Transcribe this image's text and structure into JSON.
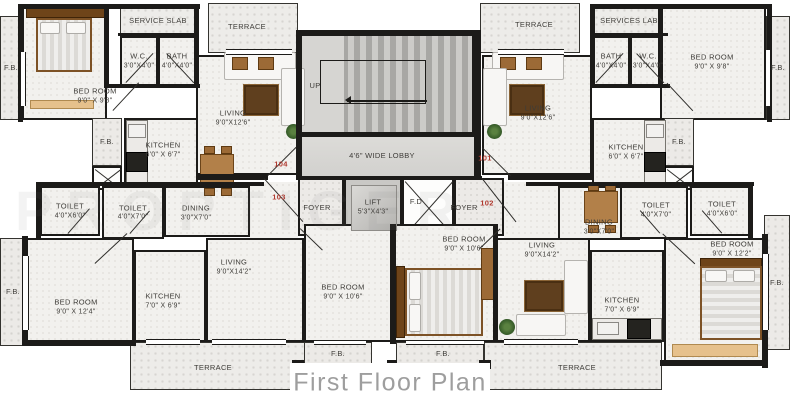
{
  "title": "First Floor Plan",
  "watermark": {
    "text": "PROPTIGER"
  },
  "colors": {
    "wall": "#1c1b19",
    "unit_number": "#b03a30",
    "title_text": "#9e9e9e",
    "room_floor": "#f2f1ee",
    "terrace_floor": "#edece9"
  },
  "units": [
    {
      "number": "104"
    },
    {
      "number": "103"
    },
    {
      "number": "101"
    },
    {
      "number": "102"
    }
  ],
  "rooms": [
    {
      "id": "fb_tl",
      "name": "F.B."
    },
    {
      "id": "bed_tl",
      "name": "BED ROOM",
      "dims": "9'0\" X 9'8\""
    },
    {
      "id": "service_l",
      "name": "SERVICE SLAB"
    },
    {
      "id": "wc_l",
      "name": "W.C.",
      "dims": "3'0\"X4'0\""
    },
    {
      "id": "bath_l",
      "name": "BATH",
      "dims": "4'0\"X4'0\""
    },
    {
      "id": "terrace_tl",
      "name": "TERRACE"
    },
    {
      "id": "living_l",
      "name": "LIVING",
      "dims": "9'0\"X12'6\""
    },
    {
      "id": "fb_ls",
      "name": "F.B."
    },
    {
      "id": "duct_l"
    },
    {
      "id": "kitchen_l",
      "name": "KITCHEN",
      "dims": "6'0\" X 6'7\""
    },
    {
      "id": "dining_l",
      "name": "DINING",
      "dims": "3'0\"X7'0\""
    },
    {
      "id": "toilet_l1",
      "name": "TOILET",
      "dims": "4'0\"X6'0\""
    },
    {
      "id": "toilet_l2",
      "name": "TOILET",
      "dims": "4'0\"X7'0\""
    },
    {
      "id": "entry_l"
    },
    {
      "id": "stairs",
      "name": "UP"
    },
    {
      "id": "lobby",
      "name": "4'6\" WIDE LOBBY"
    },
    {
      "id": "foyer_l",
      "name": "FOYER"
    },
    {
      "id": "lift",
      "name": "LIFT",
      "dims": "5'3\"X4'3\""
    },
    {
      "id": "fd",
      "name": "F.D"
    },
    {
      "id": "foyer_r",
      "name": "FOYER"
    },
    {
      "id": "entry_r"
    },
    {
      "id": "terrace_tr",
      "name": "TERRACE"
    },
    {
      "id": "living_r",
      "name": "LIVING",
      "dims": "9'0\"X12'6\""
    },
    {
      "id": "service_r",
      "name": "SERVICES LAB"
    },
    {
      "id": "bath_r",
      "name": "BATH",
      "dims": "4'0\"X4'0\""
    },
    {
      "id": "wc_r",
      "name": "W.C.",
      "dims": "3'0\"X4'0\""
    },
    {
      "id": "bed_tr",
      "name": "BED ROOM",
      "dims": "9'0\" X 9'8\""
    },
    {
      "id": "fb_tr",
      "name": "F.B."
    },
    {
      "id": "kitchen_r",
      "name": "KITCHEN",
      "dims": "6'0\" X 6'7\""
    },
    {
      "id": "fb_rs",
      "name": "F.B."
    },
    {
      "id": "duct_r"
    },
    {
      "id": "dining_r",
      "name": "DINING",
      "dims": "3'0\"X7'0\""
    },
    {
      "id": "toilet_r1",
      "name": "TOILET",
      "dims": "4'0\"X7'0\""
    },
    {
      "id": "toilet_r2",
      "name": "TOILET",
      "dims": "4'0\"X6'0\""
    },
    {
      "id": "fb_bl",
      "name": "F.B."
    },
    {
      "id": "bed_bl",
      "name": "BED ROOM",
      "dims": "9'0\" X 12'4\""
    },
    {
      "id": "kitchen_bl",
      "name": "KITCHEN",
      "dims": "7'0\" X 6'9\""
    },
    {
      "id": "living_bl",
      "name": "LIVING",
      "dims": "9'0\"X14'2\""
    },
    {
      "id": "bed_bc_l",
      "name": "BED ROOM",
      "dims": "9'0\" X 10'6\""
    },
    {
      "id": "bed_bc_r",
      "name": "BED ROOM",
      "dims": "9'0\" X 10'6\""
    },
    {
      "id": "living_br",
      "name": "LIVING",
      "dims": "9'0\"X14'2\""
    },
    {
      "id": "kitchen_br",
      "name": "KITCHEN",
      "dims": "7'0\" X 6'9\""
    },
    {
      "id": "bed_br",
      "name": "BED ROOM",
      "dims": "9'0\" X 12'2\""
    },
    {
      "id": "fb_br",
      "name": "F.B."
    },
    {
      "id": "terrace_bl",
      "name": "TERRACE"
    },
    {
      "id": "fb_bc_l",
      "name": "F.B."
    },
    {
      "id": "fb_bc_r",
      "name": "F.B."
    },
    {
      "id": "terrace_br",
      "name": "TERRACE"
    }
  ]
}
